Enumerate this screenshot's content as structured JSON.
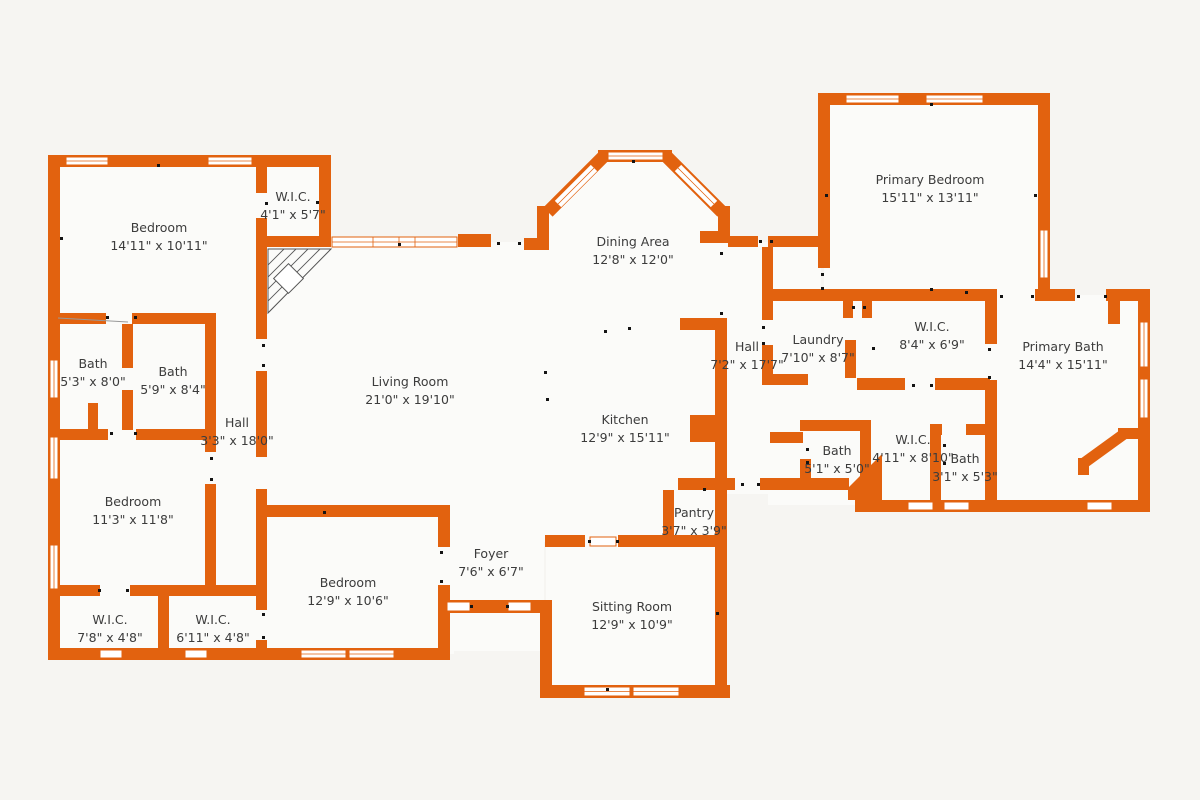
{
  "plan": {
    "type": "floor-plan",
    "colors": {
      "wall": "#e2620f",
      "background": "#f6f5f2",
      "floor": "#fbfbf9",
      "text": "#3c3c3c",
      "marker": "#141414"
    }
  },
  "rooms": [
    {
      "name": "Bedroom",
      "dims": "14'11\" x 10'11\""
    },
    {
      "name": "W.I.C.",
      "dims": "4'1\" x 5'7\""
    },
    {
      "name": "Bath",
      "dims": "5'3\" x 8'0\""
    },
    {
      "name": "Bath",
      "dims": "5'9\" x 8'4\""
    },
    {
      "name": "Hall",
      "dims": "3'3\" x 18'0\""
    },
    {
      "name": "Bedroom",
      "dims": "11'3\" x 11'8\""
    },
    {
      "name": "W.I.C.",
      "dims": "7'8\" x 4'8\""
    },
    {
      "name": "W.I.C.",
      "dims": "6'11\" x 4'8\""
    },
    {
      "name": "Bedroom",
      "dims": "12'9\" x 10'6\""
    },
    {
      "name": "Living Room",
      "dims": "21'0\" x 19'10\""
    },
    {
      "name": "Dining Area",
      "dims": "12'8\" x 12'0\""
    },
    {
      "name": "Kitchen",
      "dims": "12'9\" x 15'11\""
    },
    {
      "name": "Pantry",
      "dims": "3'7\" x 3'9\""
    },
    {
      "name": "Foyer",
      "dims": "7'6\" x 6'7\""
    },
    {
      "name": "Sitting Room",
      "dims": "12'9\" x 10'9\""
    },
    {
      "name": "Primary Bedroom",
      "dims": "15'11\" x 13'11\""
    },
    {
      "name": "Hall",
      "dims": "7'2\" x 17'7\""
    },
    {
      "name": "Laundry",
      "dims": "7'10\" x 8'7\""
    },
    {
      "name": "W.I.C.",
      "dims": "8'4\" x 6'9\""
    },
    {
      "name": "Primary Bath",
      "dims": "14'4\" x 15'11\""
    },
    {
      "name": "Bath",
      "dims": "5'1\" x 5'0\""
    },
    {
      "name": "W.I.C.",
      "dims": "4'11\" x 8'10\""
    },
    {
      "name": "Bath",
      "dims": "3'1\" x 5'3\""
    }
  ]
}
